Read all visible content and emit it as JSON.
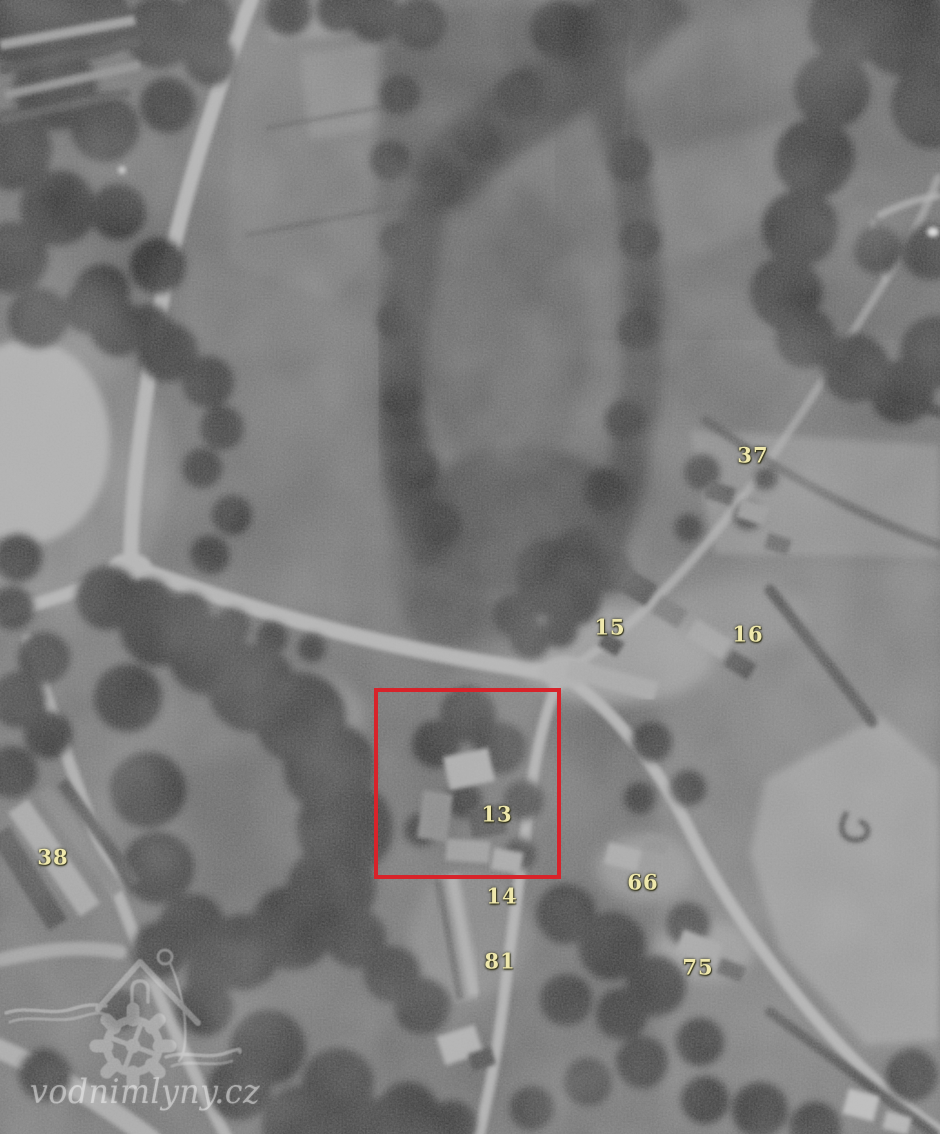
{
  "image": {
    "alt": "Historical black-and-white aerial photograph of a village: dark wooded stream valley in the centre, light roads converging at a junction, fields on the right, scattered farm buildings",
    "width_px": 940,
    "height_px": 1134
  },
  "annotations": {
    "label_color": "#efe8ac",
    "house_number_labels": [
      {
        "text": "37",
        "x": 753,
        "y": 455
      },
      {
        "text": "15",
        "x": 610,
        "y": 627
      },
      {
        "text": "16",
        "x": 748,
        "y": 634
      },
      {
        "text": "13",
        "x": 497,
        "y": 814
      },
      {
        "text": "38",
        "x": 53,
        "y": 857
      },
      {
        "text": "66",
        "x": 643,
        "y": 882
      },
      {
        "text": "14",
        "x": 502,
        "y": 896
      },
      {
        "text": "81",
        "x": 500,
        "y": 961
      },
      {
        "text": "75",
        "x": 698,
        "y": 967
      }
    ],
    "highlight_box": {
      "x": 374,
      "y": 688,
      "width": 187,
      "height": 191,
      "border_color": "#d8232a",
      "border_width": 4
    }
  },
  "watermark": {
    "text": "vodnimlyny.cz",
    "logo": "watermill-house-gear-icon",
    "color": "rgba(250,250,250,0.42)"
  }
}
